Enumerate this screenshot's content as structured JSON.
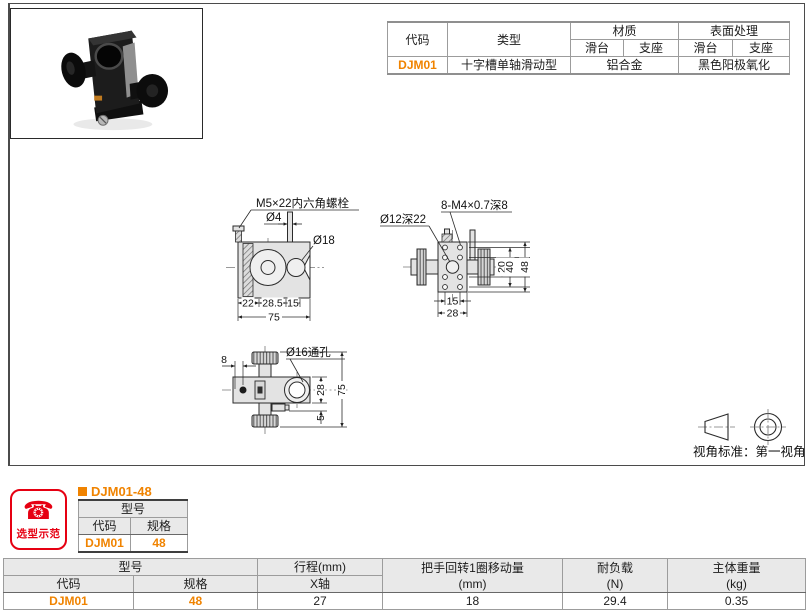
{
  "colors": {
    "accent_orange": "#f08300",
    "badge_red": "#e60012",
    "header_bg": "#e9e9e9"
  },
  "spec_table": {
    "col_code": "代码",
    "col_type": "类型",
    "col_material": "材质",
    "col_surface": "表面处理",
    "sub_slide": "滑台",
    "sub_base": "支座",
    "sub_slide2": "滑台",
    "sub_base2": "支座",
    "row": {
      "code": "DJM01",
      "type": "十字槽单轴滑动型",
      "material": "铝合金",
      "surface": "黑色阳极氧化"
    }
  },
  "drawings": {
    "front": {
      "bolt_label": "M5×22内六角螺栓",
      "dia4_label": "Ø4",
      "dia18_label": "Ø18",
      "dim_22": "22",
      "dim_28_5": "28.5",
      "dim_15": "15",
      "dim_75": "75"
    },
    "side": {
      "holes_label": "8-M4×0.7深8",
      "dia12_label": "Ø12深22",
      "dim_20": "20",
      "dim_40": "40",
      "dim_48": "48",
      "dim_15": "15",
      "dim_28": "28"
    },
    "top": {
      "dia16_label": "Ø16通孔",
      "dim_8": "8",
      "dim_28": "28",
      "dim_75": "75",
      "dim_5": "5"
    }
  },
  "view_standard": {
    "label": "视角标准：第一视角"
  },
  "selection_badge": {
    "phone_icon": "☎",
    "label": "选型示范"
  },
  "example": {
    "title": "DJM01-48",
    "col_model": "型号",
    "col_code": "代码",
    "col_spec": "规格",
    "code": "DJM01",
    "spec": "48"
  },
  "dimension_table": {
    "col_model": "型号",
    "col_code": "代码",
    "col_spec": "规格",
    "col_travel": "行程(mm)",
    "col_x_axis": "X轴",
    "col_movement_1": "把手回转1圈移动量",
    "col_movement_2": "(mm)",
    "col_load_1": "耐负载",
    "col_load_2": "(N)",
    "col_weight_1": "主体重量",
    "col_weight_2": "(kg)",
    "row": {
      "code": "DJM01",
      "spec": "48",
      "travel_x": "27",
      "movement": "18",
      "load": "29.4",
      "weight": "0.35"
    }
  }
}
